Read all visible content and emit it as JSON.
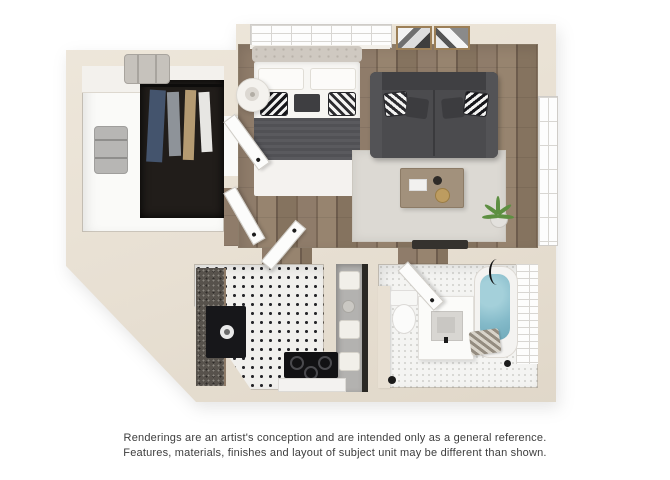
{
  "disclaimer": {
    "line1": "Renderings are an artist's conception and are intended only as a general reference.",
    "line2": "Features, materials, finishes and layout of subject unit may be different than shown."
  },
  "colors": {
    "background": "#ffffff",
    "wall": "#e8e0d3",
    "wood_floor": "#86735f",
    "kitchen_tile": "#f1f0ed",
    "bathroom_tile": "#f4f4f2",
    "closet_floor": "#fafaf8",
    "rug": "#dcd9d3",
    "sofa": "#4b4b4e",
    "bed_blanket": "#57575b",
    "tub_water": "#84bac9",
    "plant": "#5d8f41",
    "disclaimer_text": "#3d3d3d"
  }
}
